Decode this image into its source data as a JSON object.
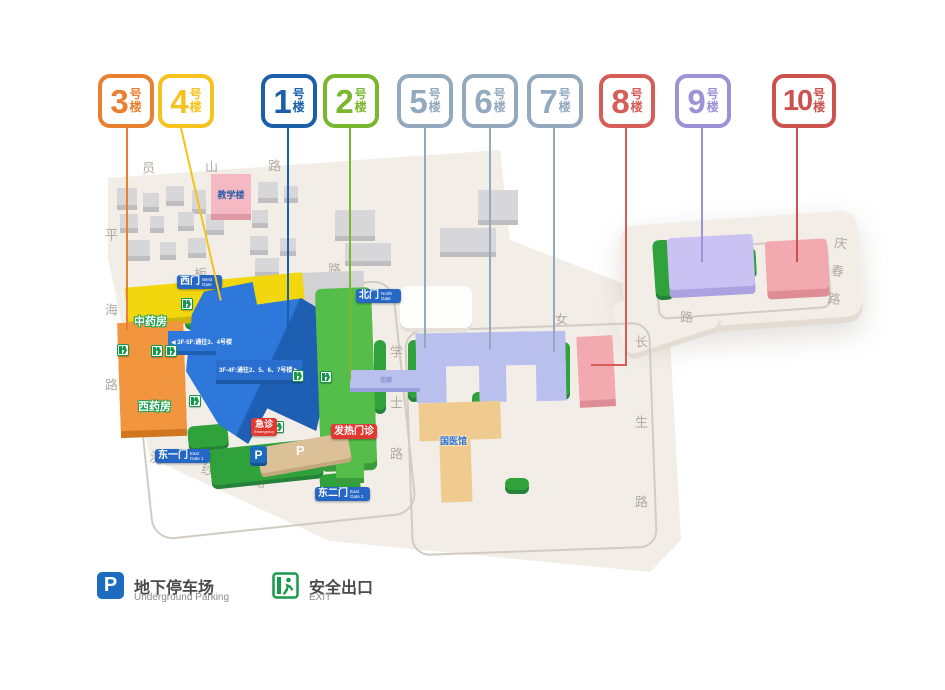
{
  "badges": [
    {
      "num": "3",
      "hao": "号",
      "lou": "楼",
      "color": "#E8802F"
    },
    {
      "num": "4",
      "hao": "号",
      "lou": "楼",
      "color": "#F5C21E"
    },
    {
      "num": "1",
      "hao": "号",
      "lou": "楼",
      "color": "#1B5FA8"
    },
    {
      "num": "2",
      "hao": "号",
      "lou": "楼",
      "color": "#79B72E"
    },
    {
      "num": "5",
      "hao": "号",
      "lou": "楼",
      "color": "#92A9BE"
    },
    {
      "num": "6",
      "hao": "号",
      "lou": "楼",
      "color": "#92A9BE"
    },
    {
      "num": "7",
      "hao": "号",
      "lou": "楼",
      "color": "#92A9BE"
    },
    {
      "num": "8",
      "hao": "号",
      "lou": "楼",
      "color": "#D65D59"
    },
    {
      "num": "9",
      "hao": "号",
      "lou": "楼",
      "color": "#9C92D6"
    },
    {
      "num": "10",
      "hao": "号",
      "lou": "楼",
      "color": "#CB524E"
    }
  ],
  "roads": {
    "yuanshan": "员山路",
    "pinghai": "平海路",
    "banqiao": "板桥路",
    "xiaonv": "孝女路",
    "xueshi": "学士路",
    "changsheng": "长生路",
    "qingchun": "庆春路",
    "huansha": "浣纱路"
  },
  "gates": {
    "west": {
      "zh": "西门",
      "en": "West Gate"
    },
    "north": {
      "zh": "北门",
      "en": "North Gate"
    },
    "east1": {
      "zh": "东一门",
      "en": "East Gate 1"
    },
    "east2": {
      "zh": "东二门",
      "en": "East Gate 2"
    }
  },
  "labels": {
    "jiaoxuelou": "教学楼",
    "zhongyaofang": "中药房",
    "xiyaofang": "西药房",
    "guoyiguan": "国医馆",
    "fare": "发热门诊",
    "jizhen": {
      "zh": "急诊",
      "en": "Emergency"
    },
    "lianlang": "连廊",
    "p": "P",
    "bridge_a": "◀ 3F-5F:通往3、4号楼",
    "bridge_b": "3F-4F:通往2、5、6、7号楼 ▶"
  },
  "legend": {
    "parking": {
      "zh": "地下停车场",
      "en": "Underground Parking",
      "icon": "P"
    },
    "exit": {
      "zh": "安全出口",
      "en": "EXIT"
    }
  },
  "palette": {
    "parcel": "#F2EDE7",
    "gate_badge_blue": "#2666C4",
    "alert_red": "#E23832",
    "exit_green": "#179A4B",
    "parking_blue": "#1C6BBF",
    "building_blue": "#2E78DC",
    "building_green": "#55BE4A",
    "building_yellow": "#F2D70E",
    "building_orange": "#F1953F",
    "building_lavender": "#B9C0EE",
    "building_pink": "#F3A9B0",
    "building_purple": "#C9C2F2",
    "building_beige": "#EFCB90"
  }
}
